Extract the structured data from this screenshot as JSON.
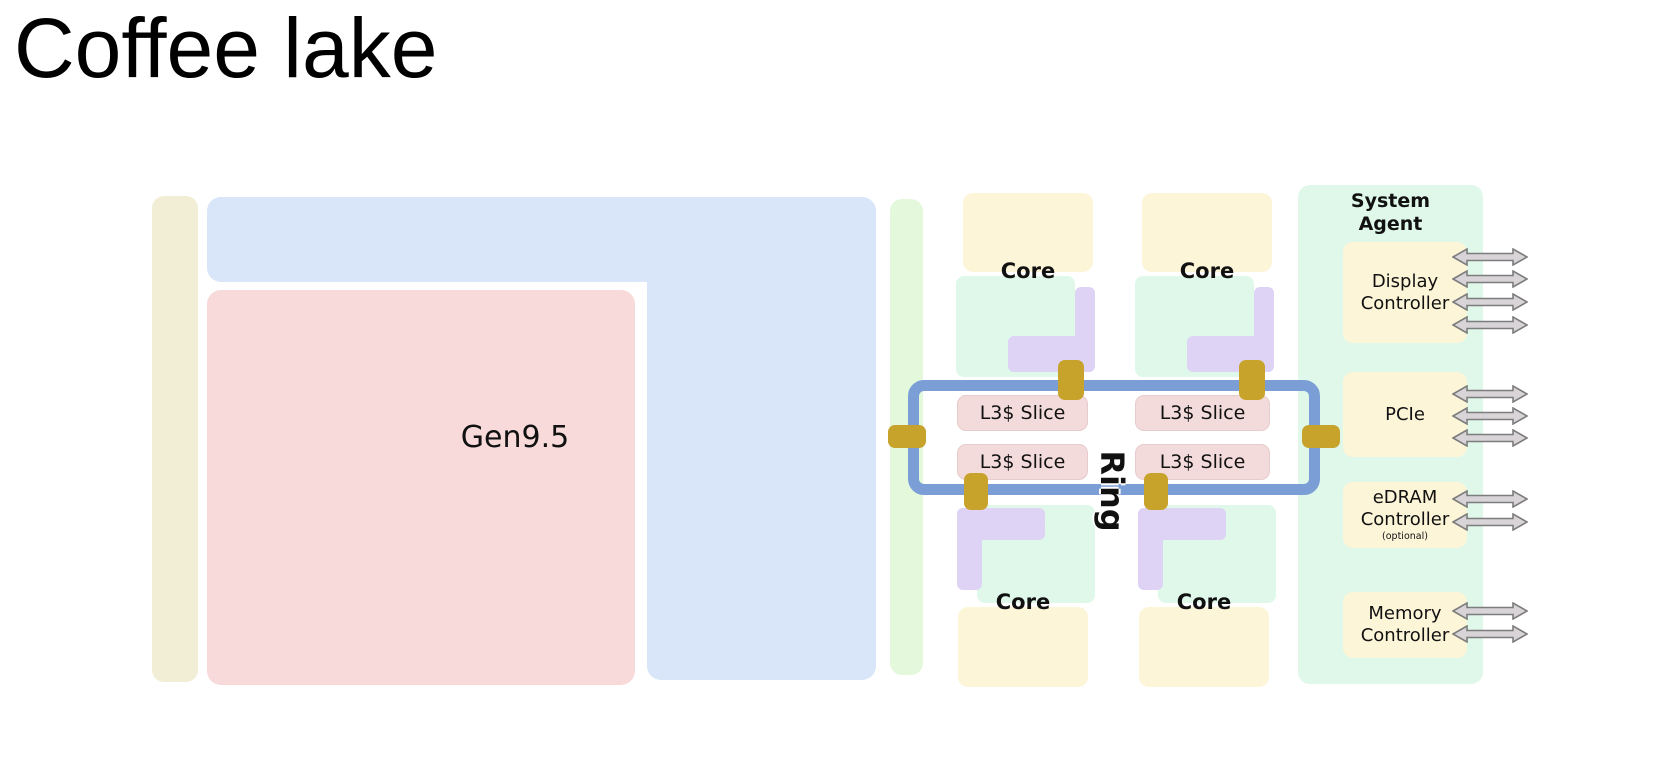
{
  "title": "Coffee lake",
  "diagram": {
    "gpu": {
      "label": "Gen9.5"
    },
    "core_label": "Core",
    "core_count": 4,
    "l3_label": "L3$ Slice",
    "l3_count": 4,
    "ring_label": "Ring",
    "system_agent": {
      "title": "System\nAgent",
      "controllers": [
        {
          "id": "display",
          "label": "Display\nController",
          "arrow_count": 4
        },
        {
          "id": "pcie",
          "label": "PCIe",
          "arrow_count": 3
        },
        {
          "id": "edram",
          "label": "eDRAM\nController",
          "note": "(optional)",
          "arrow_count": 2
        },
        {
          "id": "memory",
          "label": "Memory\nController",
          "arrow_count": 2
        }
      ]
    }
  },
  "colors": {
    "page_bg": "#ffffff",
    "title_text": "#000000",
    "label_text": "#111111",
    "tan": "#f2eed6",
    "gpu_blue": "#d9e5f8",
    "gpu_pink": "#f8dada",
    "pale_green": "#e4f9dc",
    "cream": "#fdf5d8",
    "mint": "#dff8e9",
    "purple": "#ded3f5",
    "l3_fill": "#f3dbdb",
    "l3_border": "#e7cccd",
    "ring_blue": "#7b9ed6",
    "gold": "#c7a32c",
    "arrow_fill": "#d8d4d8",
    "arrow_stroke": "#7d7d7d"
  }
}
